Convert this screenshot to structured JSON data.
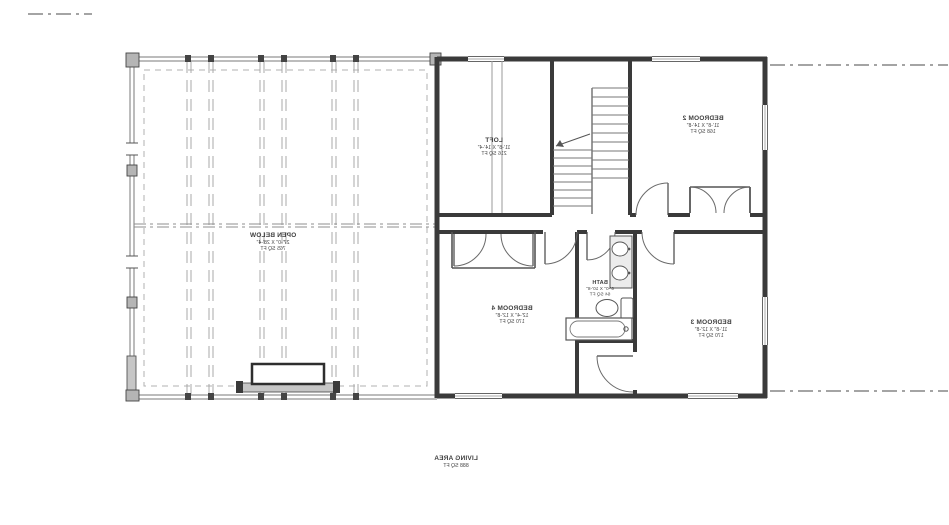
{
  "plan": {
    "rooms": {
      "open_below": {
        "name": "OPEN BELOW",
        "dims": "27'-0\" X 28'-4\"",
        "area": "765 SQ FT"
      },
      "loft": {
        "name": "LOFT",
        "dims": "11'-8\" X 14'-4\"",
        "area": "216 SQ FT"
      },
      "bedroom_2": {
        "name": "BEDROOM 2",
        "dims": "11'-8\" X 14'-8\"",
        "area": "168 SQ FT"
      },
      "bedroom_3": {
        "name": "BEDROOM 3",
        "dims": "11'-8\" X 12'-8\"",
        "area": "170 SQ FT"
      },
      "bedroom_4": {
        "name": "BEDROOM 4",
        "dims": "12'-4\" X 12'-8\"",
        "area": "170 SQ FT"
      },
      "bath": {
        "name": "BATH",
        "dims": "6'-0\" X 10'-8\"",
        "area": "64 SQ FT"
      }
    },
    "footer": {
      "label": "LIVING AREA",
      "area": "888 SQ FT"
    },
    "text_orientation": "mirrored",
    "colors": {
      "wall": "#3a3a3a",
      "thin_line": "#8f8f8f",
      "beam_line": "#a8a8a8",
      "fill_gray": "#c6c6c6",
      "text": "#3f3f3f"
    }
  }
}
